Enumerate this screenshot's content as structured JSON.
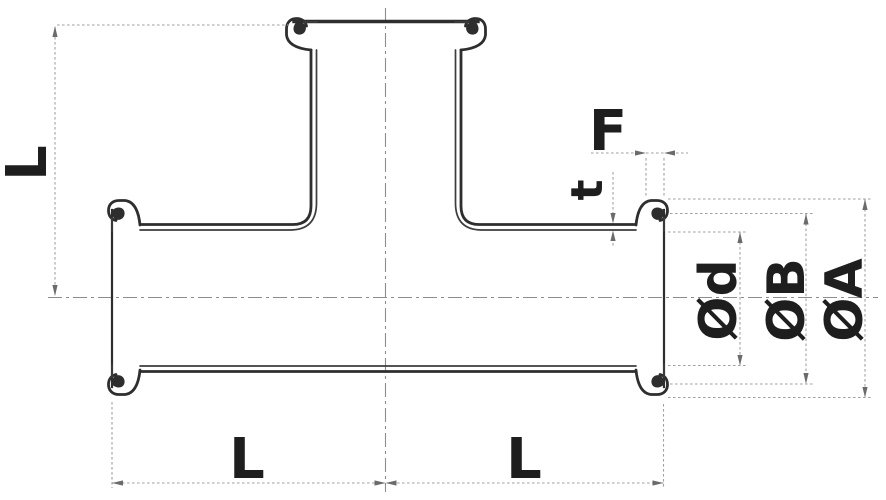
{
  "diagram": {
    "title": "Clamp-end tee fitting engineering drawing",
    "type": "engineering-drawing",
    "view": "sectioned side view of a tee with clamp ferrule ends",
    "dimension_labels": {
      "branch_length": "L",
      "run_left_length": "L",
      "run_right_length": "L",
      "ferrule_flange_width": "F",
      "wall_thickness": "t",
      "inner_diameter": "Ød",
      "bead_diameter": "ØB",
      "flange_outer_diameter": "ØA"
    },
    "colors": {
      "outline": "#2e2e2e",
      "dimension_lines": "#a2a2a2",
      "centerlines": "#8d8d8d",
      "label_text": "#1e1e1e",
      "background": "#ffffff"
    }
  }
}
